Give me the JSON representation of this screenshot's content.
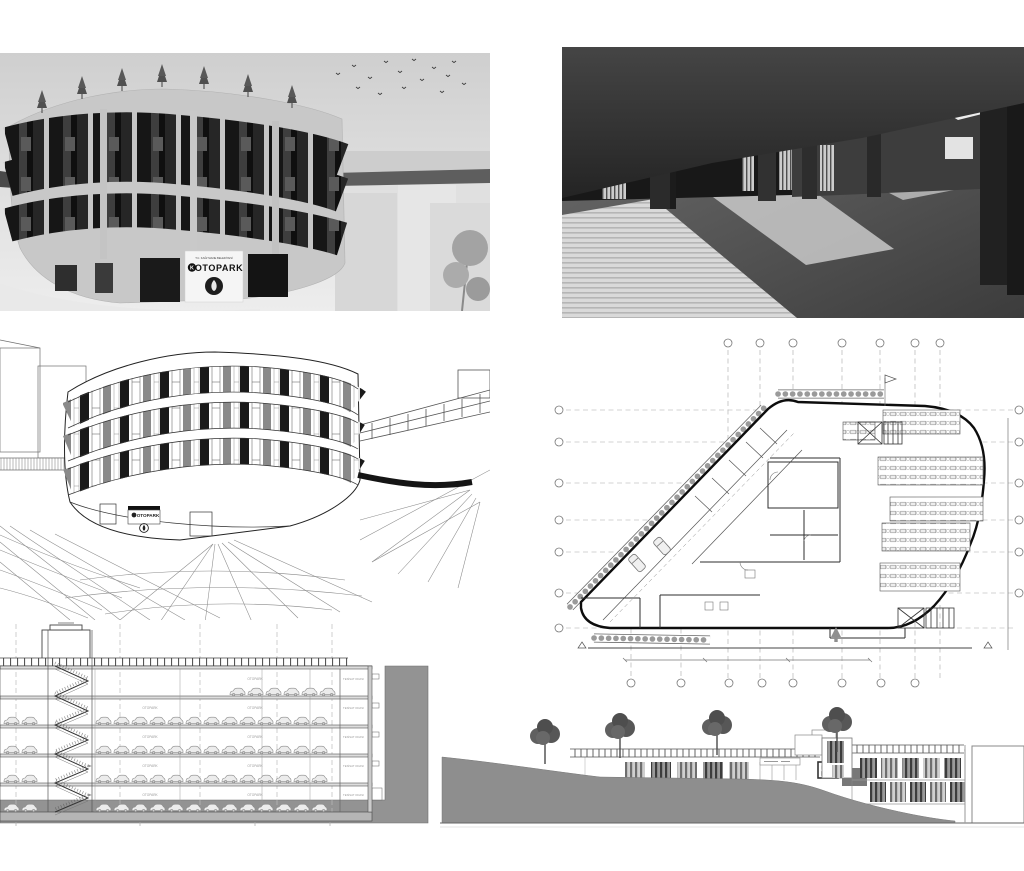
{
  "board": {
    "background": "#ffffff",
    "description_colors": {
      "render_sky": "#d6d6d6",
      "dark_glass": "#1c1c1c",
      "concrete_light": "#c8c8c8",
      "earth_gray": "#8e8e8e",
      "line_ink": "#2a2a2a",
      "interior_dark": "#2b2b2b"
    }
  },
  "branding": {
    "sign_header": "T.C. KAĞITHANE BELEDİYESİ",
    "logo_letter": "K",
    "project_sign": "OTOPARK"
  },
  "section": {
    "floor_label": "OTOPARK",
    "plant_room_label": "TESİSAT ODASI"
  }
}
